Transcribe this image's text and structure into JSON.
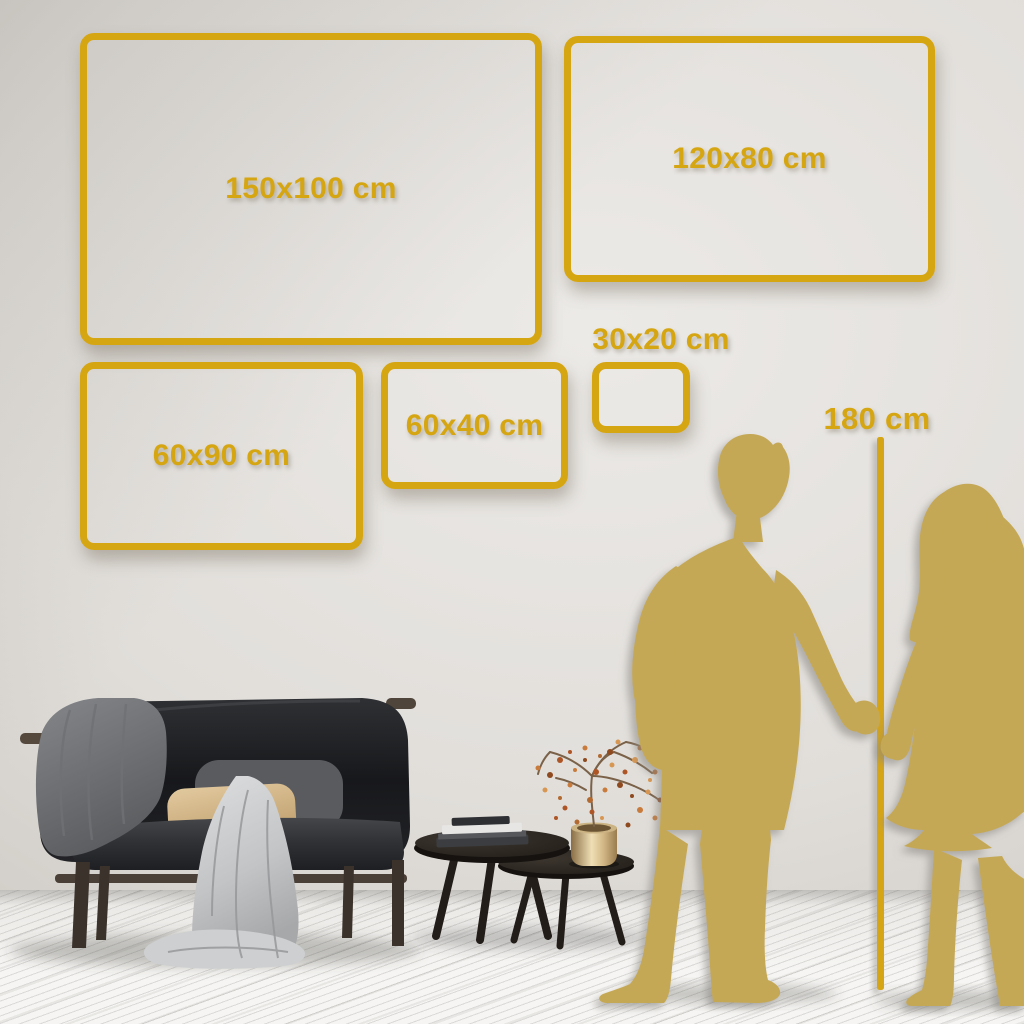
{
  "size_guide": {
    "unit": "cm",
    "size_options": [
      {
        "label": "150x100 cm",
        "width_cm": 150,
        "height_cm": 100
      },
      {
        "label": "120x80 cm",
        "width_cm": 120,
        "height_cm": 80
      },
      {
        "label": "60x90 cm",
        "width_cm": 60,
        "height_cm": 90
      },
      {
        "label": "60x40 cm",
        "width_cm": 60,
        "height_cm": 40
      },
      {
        "label": "30x20 cm",
        "width_cm": 30,
        "height_cm": 20
      }
    ],
    "height_marker": {
      "label": "180 cm",
      "value_cm": 180
    }
  },
  "colors": {
    "accent_gold": "#D6A512",
    "silhouette_gold": "#C5A854",
    "wall": "#E1DEDA",
    "floor": "#F2F1EF"
  },
  "icons": {
    "couple": "couple-holding-hands-silhouette",
    "measure_line": "vertical-height-line",
    "sofa": "dark-sofa-with-throw-blankets-and-pillows",
    "tables": "nesting-coffee-tables-with-books-vase-and-berry-plant"
  }
}
